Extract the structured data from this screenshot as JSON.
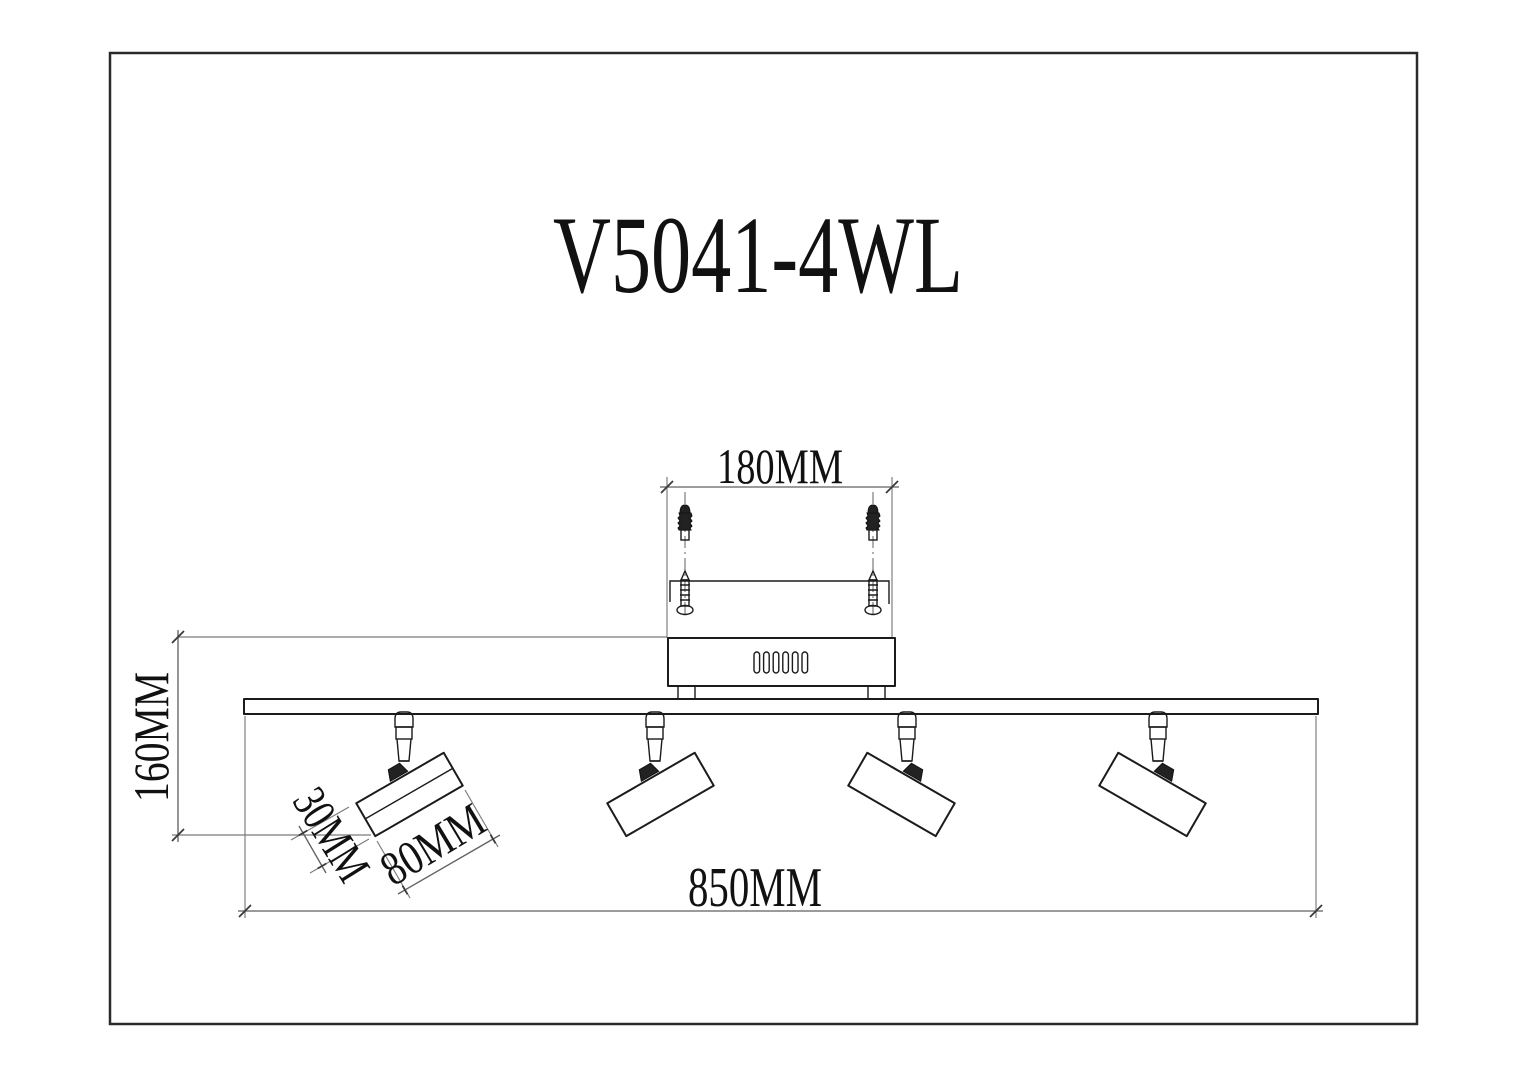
{
  "drawing": {
    "title": "V5041-4WL",
    "dimensions": {
      "mounting_width": "180MM",
      "fixture_height": "160MM",
      "head_diameter": "30MM",
      "head_length": "80MM",
      "bar_length": "850MM"
    },
    "colors": {
      "line": "#1b1b1b",
      "dimension_line": "#5f5f5f",
      "background": "#ffffff"
    }
  }
}
